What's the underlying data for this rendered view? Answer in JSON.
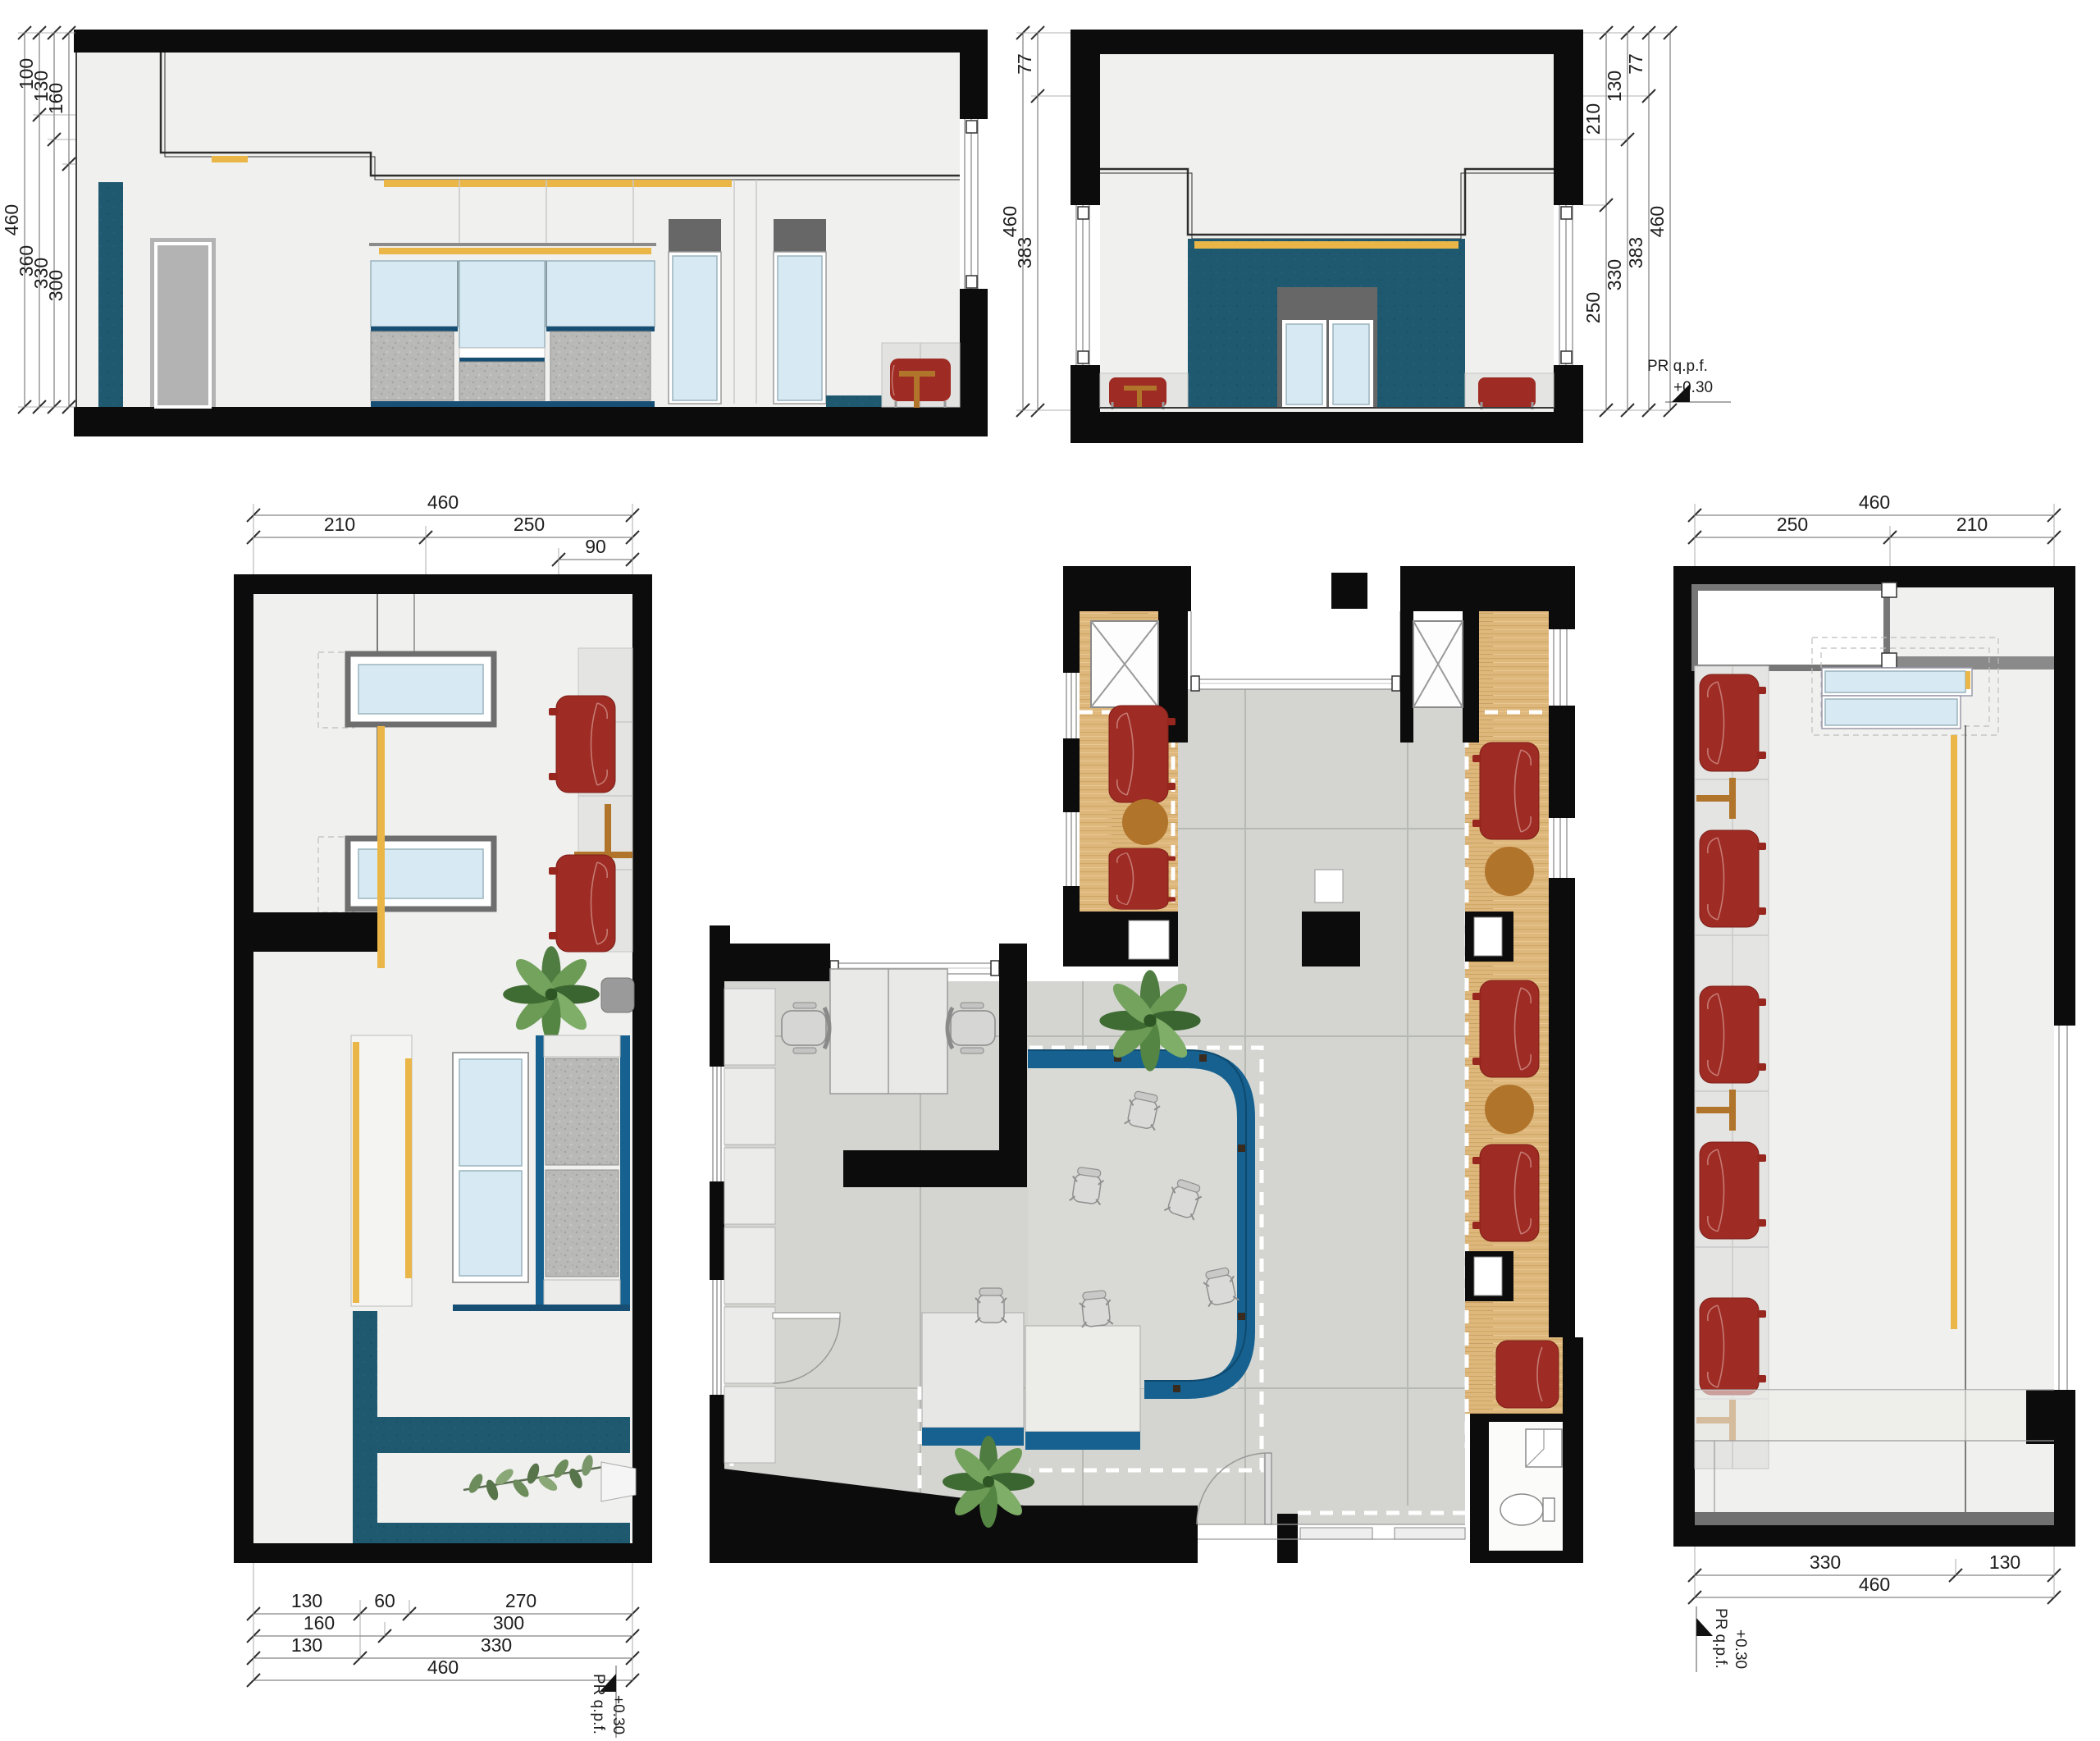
{
  "drawing": {
    "type": "architectural plan and interior elevations",
    "level_note": {
      "label": "PR q.p.f.",
      "value": "+0.30"
    }
  },
  "colors": {
    "wall_black": "#0c0c0c",
    "wall_fill": "#f0f0ee",
    "teal_wall": "#1f5970",
    "counter_blue": "#16618f",
    "accent_yellow": "#eab648",
    "glass_blue": "#d7eaf3",
    "armchair_red": "#9e2b24",
    "table_brown": "#b1742b",
    "wood_floor": "#deb77c",
    "tile_floor": "#d4d5d0"
  },
  "dims": {
    "elev_a": {
      "c1": [
        "460"
      ],
      "c2": [
        "100",
        "360"
      ],
      "c3": [
        "130",
        "330"
      ],
      "c4": [
        "160",
        "300"
      ]
    },
    "elev_b": {
      "lc1": [
        "460"
      ],
      "lc2": [
        "77",
        "383"
      ],
      "rc1": [
        "210",
        "250"
      ],
      "rc2": [
        "130",
        "330"
      ],
      "rc3": [
        "77",
        "383"
      ],
      "rc4": [
        "460"
      ]
    },
    "plan_c": {
      "t1": [
        "460"
      ],
      "t2": [
        "210",
        "250"
      ],
      "t3": [
        "90"
      ],
      "b1": [
        "130",
        "60",
        "270"
      ],
      "b2": [
        "160",
        "300"
      ],
      "b3": [
        "130",
        "330"
      ],
      "b4": [
        "460"
      ]
    },
    "plan_d": {
      "t1": [
        "460"
      ],
      "t2": [
        "250",
        "210"
      ],
      "b1": [
        "330",
        "130"
      ],
      "b2": [
        "460"
      ]
    }
  }
}
